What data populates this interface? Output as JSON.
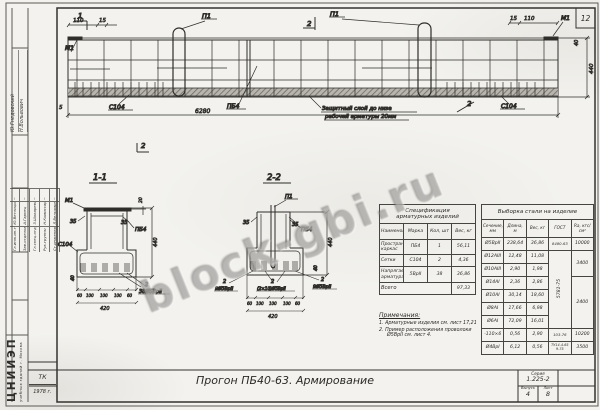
{
  "watermark": {
    "text": "block-gbi.ru"
  },
  "sheet": {
    "corner_number": "12",
    "title": "Прогон ПБ40-63. Армирование",
    "series_label": "Серия",
    "series": "1.225-2",
    "issue_label": "Выпуск",
    "issue": "4",
    "sheet_label": "Лист",
    "sheet_no": "8",
    "tk": "ТК",
    "year": "1978 г.",
    "org_big": "ЦНИИЭП",
    "org_small": "учебных зданий г. Москва"
  },
  "stamp": {
    "approved": [
      {
        "name": "Ю.Гнедовский"
      },
      {
        "name": "Н.Вольвович"
      }
    ],
    "rows": [
      {
        "role": "Гл.инж.ин-та",
        "name": "Ю.Ветлицын",
        "sign": "~"
      },
      {
        "role": "Зав.отделом",
        "name": "А.Гарнец",
        "sign": "~"
      },
      {
        "role": "Гл.спец.отд.",
        "name": "З.Шокарева",
        "sign": "~"
      },
      {
        "role": "Рук.группы",
        "name": "Н.Комиссарова",
        "sign": "~"
      },
      {
        "role": "Ст.инженер",
        "name": "Л.Вельяминова",
        "sign": "~"
      }
    ]
  },
  "elevation": {
    "cut1": "1",
    "cut2_top": "2",
    "cut2_bottom": "2",
    "cut2_right": "2",
    "dim_110_left": "110",
    "dim_15_left": "15",
    "dim_15_right": "15",
    "dim_110_right": "110",
    "m1_left": "М1",
    "m1_right": "М1",
    "p1_left": "П1",
    "p1_right": "П1",
    "c104_left": "С104",
    "c104_right": "С104",
    "pb4": "ПБ4",
    "dim_total": "6280",
    "dim_5": "5",
    "dim_440": "440",
    "dim_40": "40",
    "note_line1": "Защитный слой до низа",
    "note_line2": "рабочей арматуры 20мм"
  },
  "section11": {
    "title": "1-1",
    "m1": "М1",
    "c104": "С104",
    "pb4": "ПБ4",
    "dim_35l": "35",
    "dim_35r": "35",
    "dim_20": "20",
    "dim_440": "440",
    "dim_40": "40",
    "chain": [
      "60",
      "100",
      "100",
      "100",
      "60"
    ],
    "width": "420",
    "qty": "2",
    "wires": "38Ø5ВрII"
  },
  "section22": {
    "title": "2-2",
    "p1": "П1",
    "pb4": "ПБ4",
    "dim_35l": "35",
    "dim_35r": "35",
    "dim_440": "440",
    "dim_40": "40",
    "chain": [
      "60",
      "100",
      "100",
      "100",
      "60"
    ],
    "width": "420",
    "left_qty": "2",
    "left_wires": "9Ø5ВрII",
    "center_qty": "2",
    "center_wires": "(2×10)Ø5ВрII",
    "right_qty": "2",
    "right_wires": "9Ø5ВрII"
  },
  "spec": {
    "title_line1": "Спецификация",
    "title_line2": "арматурных изделий",
    "headers": [
      "Наименование",
      "Марка",
      "Кол, шт",
      "Вес, кг"
    ],
    "rows": [
      [
        "Пространственный каркас",
        "ПБ4",
        "1",
        "56,11"
      ],
      [
        "Сетки",
        "С104",
        "2",
        "4,36"
      ],
      [
        "Напрягаемая арматура",
        "5ВрII",
        "38",
        "36,86"
      ]
    ],
    "total_label": "Всего",
    "total_value": "97,33"
  },
  "takeoff": {
    "title": "Выборка стали на изделие",
    "headers": [
      "Сечение, мм",
      "Длина, м",
      "Вес, кг",
      "ГОСТ",
      "Rа, кгс/см²"
    ],
    "rows": [
      [
        "Ø5ВрII",
        "238,64",
        "36,86"
      ],
      [
        "Ø12АIII",
        "12,48",
        "11,08"
      ],
      [
        "Ø10АIII",
        "2,90",
        "1,98"
      ],
      [
        "Ø14АI",
        "2,36",
        "2,86"
      ],
      [
        "Ø10АI",
        "30,14",
        "18,60"
      ],
      [
        "Ø8АI",
        "17,66",
        "6,98"
      ],
      [
        "Ø6АI",
        "72,09",
        "16,01"
      ],
      [
        "-110×6",
        "0,56",
        "2,90"
      ],
      [
        "Ø4ВрI",
        "6,12",
        "0,56"
      ]
    ],
    "gost_r1": "8480-63",
    "gost_r2_7": "5781-75",
    "gost_r8": "103-76",
    "gost_r9": "ТУ14-4-659-75",
    "ra_r1": "10000",
    "ra_r2_3": "3400",
    "ra_r4_7": "2400",
    "ra_r8": "10200",
    "ra_r9": "3500"
  },
  "notes": {
    "title": "Примечания:",
    "item1": "1. Арматурные изделия см. лист 17,21",
    "item2": "2. Пример расположения проволоки",
    "item2b": "Ø5ВрII см. лист 4."
  }
}
